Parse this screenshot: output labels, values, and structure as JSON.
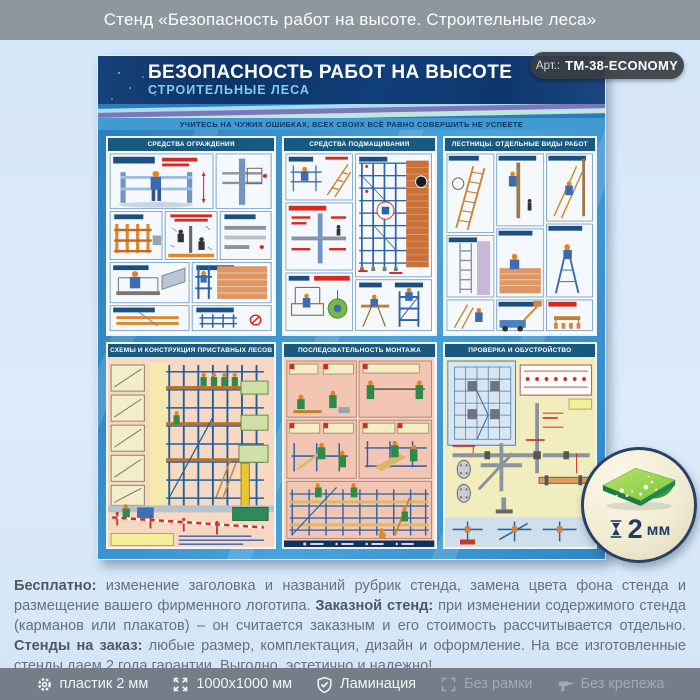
{
  "page_title": "Стенд «Безопасность работ на высоте. Строительные леса»",
  "art_badge": {
    "prefix": "Арт.:",
    "code": "ТМ-38-ECONOMY"
  },
  "poster": {
    "title": "БЕЗОПАСНОСТЬ РАБОТ НА ВЫСОТЕ",
    "subtitle": "СТРОИТЕЛЬНЫЕ ЛЕСА",
    "motto": "УЧИТЕСЬ НА ЧУЖИХ ОШИБКАХ, ВСЕХ СВОИХ ВСЁ РАВНО СОВЕРШИТЬ НЕ УСПЕЕТЕ",
    "panels": [
      {
        "title": "СРЕДСТВА ОГРАЖДЕНИЯ"
      },
      {
        "title": "СРЕДСТВА ПОДМАЩИВАНИЯ"
      },
      {
        "title": "ЛЕСТНИЦЫ. ОТДЕЛЬНЫЕ ВИДЫ РАБОТ"
      },
      {
        "title": "СХЕМЫ И КОНСТРУКЦИЯ ПРИСТАВНЫХ ЛЕСОВ"
      },
      {
        "title": "ПОСЛЕДОВАТЕЛЬНОСТЬ МОНТАЖА"
      },
      {
        "title": "ПРОВЕРКА И ОБУСТРОЙСТВО"
      }
    ]
  },
  "thickness_badge": {
    "value": "2",
    "unit": "мм"
  },
  "description": {
    "segments": [
      {
        "text": "Бесплатно:",
        "bold": true
      },
      {
        "text": " изменение заголовка и названий рубрик стенда, замена цвета фона стенда и размещение вашего фирменного логотипа. ",
        "bold": false
      },
      {
        "text": "Заказной стенд:",
        "bold": true
      },
      {
        "text": " при изменении содержимого стенда (карманов или плакатов) – он считается заказным и его стоимость рассчитывается отдельно. ",
        "bold": false
      },
      {
        "text": "Стенды на заказ:",
        "bold": true
      },
      {
        "text": " любые размер, комплектация, дизайн и оформление. На все изготовленные стенды даем 2 года гарантии. Выгодно, эстетично и надежно!",
        "bold": false
      }
    ]
  },
  "footer": {
    "items": [
      {
        "icon": "gear-icon",
        "label": "пластик 2 мм"
      },
      {
        "icon": "expand-icon",
        "label": "1000x1000 мм"
      },
      {
        "icon": "shield-check-icon",
        "label": "Ламинация"
      },
      {
        "icon": "frame-icon",
        "label": "Без рамки"
      },
      {
        "icon": "drill-icon",
        "label": "Без крепежа"
      }
    ]
  },
  "colors": {
    "header_navy": "#0f3d77",
    "accent_cyan": "#79d0e9",
    "poster_blue": "#3a93cd",
    "plastic_green": "#7ec83f",
    "bar_gray": "#747e88",
    "page_bg": "#dcebfa"
  }
}
